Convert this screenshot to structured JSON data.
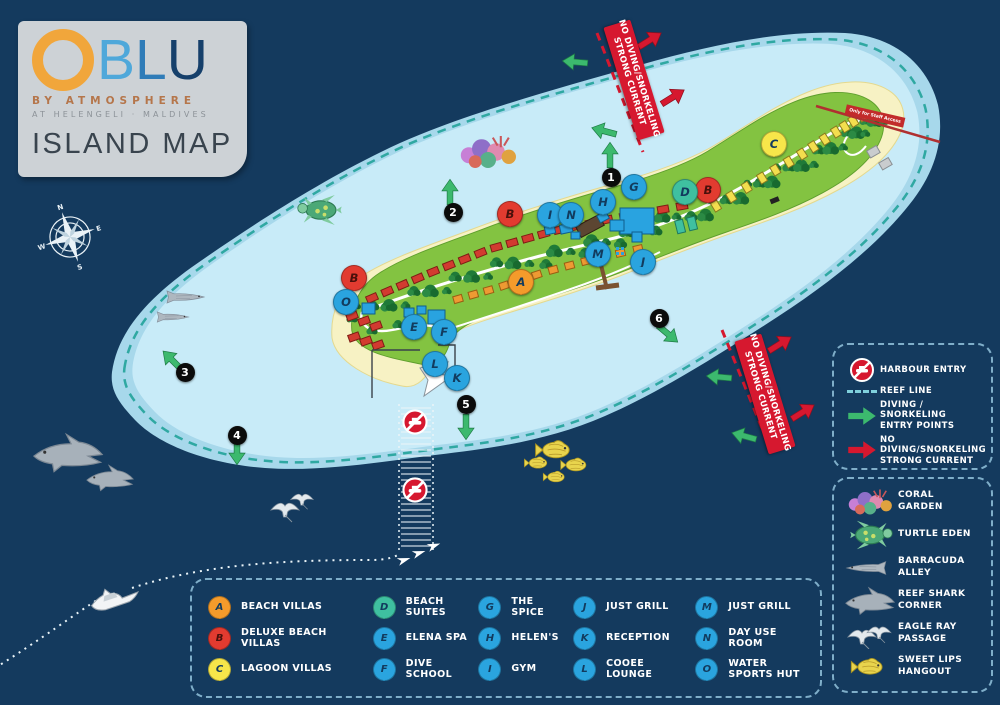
{
  "logo": {
    "brand_o": "O",
    "brand_rest_b": "B",
    "brand_rest_l": "L",
    "brand_rest_u": "U",
    "byline": "BY ATMOSPHERE",
    "location": "AT HELENGELI · MALDIVES",
    "title": "ISLAND MAP"
  },
  "colors": {
    "sea": "#143A5E",
    "lagoon_outer": "#A7D8EB",
    "lagoon_inner": "#C8EBF8",
    "reef_line": "#2FA8A2",
    "sand": "#F7F2C4",
    "island_green": "#83C341",
    "pin_blue": "#2AA4DF",
    "pin_red": "#E23B30",
    "pin_orange": "#F49B2B",
    "pin_yellow": "#F7E64A",
    "pin_teal": "#3FC0A0",
    "arrow_green": "#3CB96E",
    "arrow_red": "#D6182F"
  },
  "map": {
    "compass": {
      "n": "N",
      "e": "E",
      "s": "S",
      "w": "W"
    },
    "current_warning": {
      "line1": "NO DIVING/SNORKELING",
      "line2": "STRONG CURRENT"
    },
    "staff_access_label": "Only for Staff Access",
    "numbered_points": [
      {
        "n": "1",
        "x": 611,
        "y": 177
      },
      {
        "n": "2",
        "x": 453,
        "y": 212
      },
      {
        "n": "3",
        "x": 185,
        "y": 372
      },
      {
        "n": "4",
        "x": 237,
        "y": 435
      },
      {
        "n": "5",
        "x": 466,
        "y": 404
      },
      {
        "n": "6",
        "x": 659,
        "y": 318
      }
    ],
    "pins": [
      {
        "letter": "A",
        "type": "beach-villas",
        "x": 520,
        "y": 300,
        "color": "#F49B2B"
      },
      {
        "letter": "B",
        "type": "deluxe-beach-villas",
        "x": 509,
        "y": 232,
        "color": "#E23B30"
      },
      {
        "letter": "B",
        "type": "deluxe-beach-villas",
        "x": 353,
        "y": 296,
        "color": "#E23B30"
      },
      {
        "letter": "B",
        "type": "deluxe-beach-villas",
        "x": 707,
        "y": 208,
        "color": "#E23B30"
      },
      {
        "letter": "C",
        "type": "lagoon-villas",
        "x": 773,
        "y": 162,
        "color": "#F7E64A"
      },
      {
        "letter": "D",
        "type": "beach-suites",
        "x": 684,
        "y": 210,
        "color": "#3FC0A0"
      },
      {
        "letter": "E",
        "type": "elena-spa",
        "x": 413,
        "y": 345,
        "color": "#2AA4DF"
      },
      {
        "letter": "F",
        "type": "dive-school",
        "x": 443,
        "y": 350,
        "color": "#2AA4DF"
      },
      {
        "letter": "G",
        "type": "the-spice",
        "x": 633,
        "y": 205,
        "color": "#2AA4DF"
      },
      {
        "letter": "H",
        "type": "helens",
        "x": 602,
        "y": 220,
        "color": "#2AA4DF"
      },
      {
        "letter": "I",
        "type": "gym",
        "x": 549,
        "y": 233,
        "color": "#2AA4DF"
      },
      {
        "letter": "N",
        "type": "day-use-room",
        "x": 570,
        "y": 233,
        "color": "#2AA4DF"
      },
      {
        "letter": "M",
        "type": "just-grill-jetty",
        "x": 597,
        "y": 272,
        "color": "#2AA4DF"
      },
      {
        "letter": "J",
        "type": "just-grill",
        "x": 642,
        "y": 280,
        "color": "#2AA4DF"
      },
      {
        "letter": "L",
        "type": "cooee-lounge",
        "x": 434,
        "y": 382,
        "color": "#2AA4DF"
      },
      {
        "letter": "K",
        "type": "reception",
        "x": 456,
        "y": 396,
        "color": "#2AA4DF"
      },
      {
        "letter": "O",
        "type": "water-sports-hut",
        "x": 345,
        "y": 320,
        "color": "#2AA4DF"
      }
    ],
    "green_arrows": [
      {
        "x": 575,
        "y": 62,
        "r": 185
      },
      {
        "x": 604,
        "y": 131,
        "r": 195
      },
      {
        "x": 610,
        "y": 155,
        "r": -90
      },
      {
        "x": 450,
        "y": 192,
        "r": -90
      },
      {
        "x": 172,
        "y": 360,
        "r": -135
      },
      {
        "x": 237,
        "y": 452,
        "r": 90
      },
      {
        "x": 466,
        "y": 427,
        "r": 90
      },
      {
        "x": 668,
        "y": 334,
        "r": 40
      },
      {
        "x": 719,
        "y": 377,
        "r": 185
      },
      {
        "x": 744,
        "y": 436,
        "r": 195
      }
    ],
    "red_arrows": [
      {
        "x": 650,
        "y": 40,
        "r": -32
      },
      {
        "x": 673,
        "y": 97,
        "r": -32
      },
      {
        "x": 780,
        "y": 344,
        "r": -32
      },
      {
        "x": 803,
        "y": 412,
        "r": -32
      }
    ],
    "no_entry_signs": [
      {
        "x": 415,
        "y": 422
      },
      {
        "x": 415,
        "y": 490
      }
    ],
    "current_banners": [
      {
        "x": 634,
        "y": 80,
        "r": 73
      },
      {
        "x": 765,
        "y": 394,
        "r": 73
      }
    ]
  },
  "legend_symbols": {
    "items": [
      {
        "icon": "harbour-no-entry-icon",
        "label": "HARBOUR ENTRY"
      },
      {
        "icon": "reef-line-icon",
        "label": "REEF LINE"
      },
      {
        "icon": "diving-entry-arrow-icon",
        "label": "DIVING / SNORKELING ENTRY POINTS"
      },
      {
        "icon": "no-diving-arrow-icon",
        "label": "NO DIVING/SNORKELING STRONG CURRENT"
      }
    ]
  },
  "legend_marine": {
    "items": [
      {
        "icon": "coral-icon",
        "label": "CORAL GARDEN"
      },
      {
        "icon": "turtle-icon",
        "label": "TURTLE EDEN"
      },
      {
        "icon": "barracuda-icon",
        "label": "BARRACUDA ALLEY"
      },
      {
        "icon": "reef-shark-icon",
        "label": "REEF SHARK CORNER"
      },
      {
        "icon": "eagle-ray-icon",
        "label": "EAGLE RAY PASSAGE"
      },
      {
        "icon": "sweet-lips-icon",
        "label": "SWEET LIPS HANGOUT"
      }
    ]
  },
  "legend_places": {
    "columns": [
      [
        {
          "letter": "A",
          "label": "BEACH VILLAS",
          "color": "#F49B2B"
        },
        {
          "letter": "B",
          "label": "DELUXE BEACH VILLAS",
          "color": "#E23B30"
        },
        {
          "letter": "C",
          "label": "LAGOON VILLAS",
          "color": "#F7E64A"
        }
      ],
      [
        {
          "letter": "D",
          "label": "BEACH SUITES",
          "color": "#3FC0A0"
        },
        {
          "letter": "E",
          "label": "ELENA SPA",
          "color": "#2AA4DF"
        },
        {
          "letter": "F",
          "label": "DIVE SCHOOL",
          "color": "#2AA4DF"
        }
      ],
      [
        {
          "letter": "G",
          "label": "THE SPICE",
          "color": "#2AA4DF"
        },
        {
          "letter": "H",
          "label": "HELEN'S",
          "color": "#2AA4DF"
        },
        {
          "letter": "I",
          "label": "GYM",
          "color": "#2AA4DF"
        }
      ],
      [
        {
          "letter": "J",
          "label": "JUST GRILL",
          "color": "#2AA4DF"
        },
        {
          "letter": "K",
          "label": "RECEPTION",
          "color": "#2AA4DF"
        },
        {
          "letter": "L",
          "label": "COOEE LOUNGE",
          "color": "#2AA4DF"
        }
      ],
      [
        {
          "letter": "M",
          "label": "JUST GRILL",
          "color": "#2AA4DF"
        },
        {
          "letter": "N",
          "label": "DAY USE ROOM",
          "color": "#2AA4DF"
        },
        {
          "letter": "O",
          "label": "WATER SPORTS HUT",
          "color": "#2AA4DF"
        }
      ]
    ]
  }
}
